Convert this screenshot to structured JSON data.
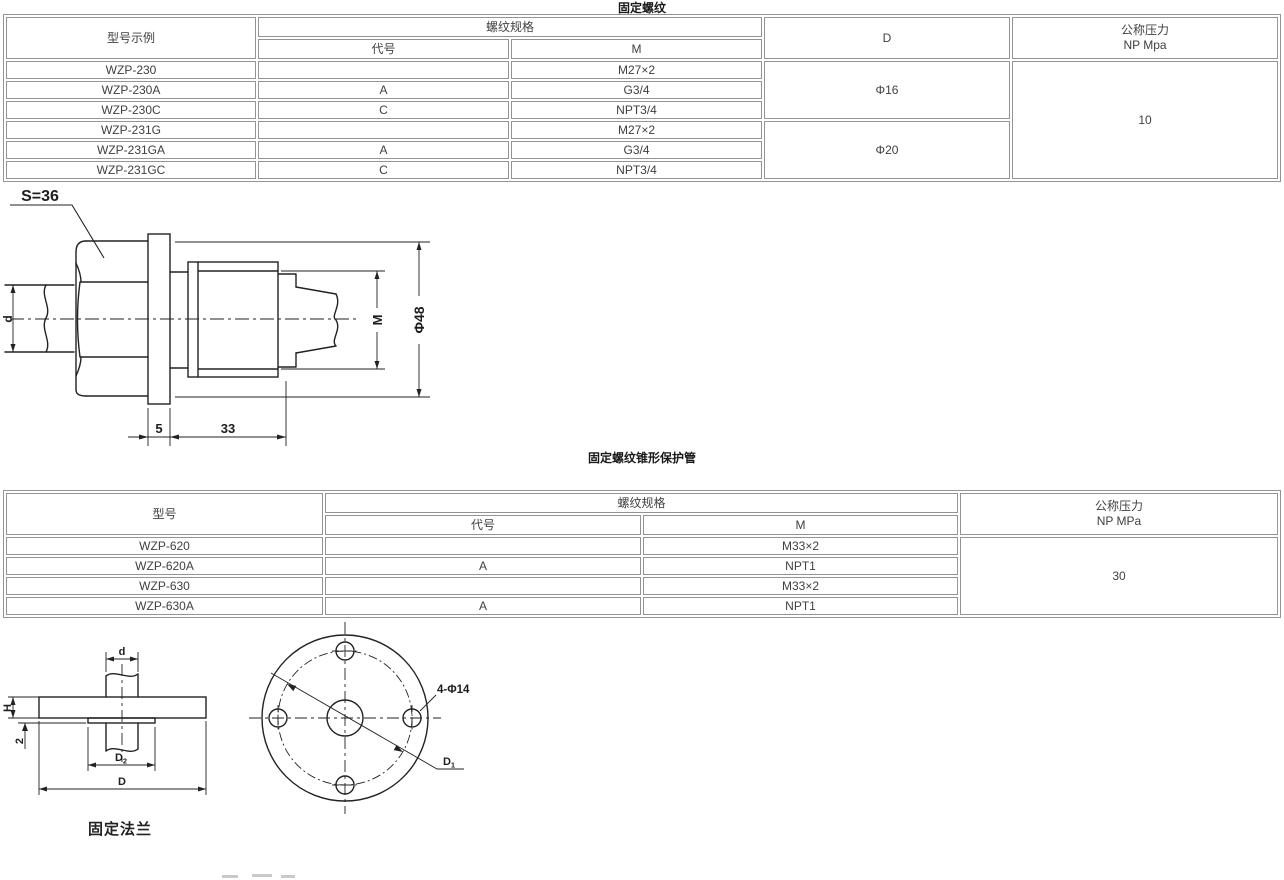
{
  "section1": {
    "title": "固定螺纹",
    "table": {
      "col_model": "型号示例",
      "col_thread_spec": "螺纹规格",
      "col_code": "代号",
      "col_m": "M",
      "col_d": "D",
      "col_pressure_l1": "公称压力",
      "col_pressure_l2": "NP Mpa",
      "rows": [
        {
          "model": "WZP-230",
          "code": "",
          "m": "M27×2"
        },
        {
          "model": "WZP-230A",
          "code": "A",
          "m": "G3/4"
        },
        {
          "model": "WZP-230C",
          "code": "C",
          "m": "NPT3/4"
        },
        {
          "model": "WZP-231G",
          "code": "",
          "m": "M27×2"
        },
        {
          "model": "WZP-231GA",
          "code": "A",
          "m": "G3/4"
        },
        {
          "model": "WZP-231GC",
          "code": "C",
          "m": "NPT3/4"
        }
      ],
      "d_group1": "Φ16",
      "d_group2": "Φ20",
      "pressure": "10"
    },
    "drawing": {
      "s_label": "S=36",
      "d_label": "d",
      "m_label": "M",
      "dia_label": "Φ48",
      "dim_5": "5",
      "dim_33": "33"
    }
  },
  "section2": {
    "title": "固定螺纹锥形保护管",
    "table": {
      "col_model": "型号",
      "col_thread_spec": "螺纹规格",
      "col_code": "代号",
      "col_m": "M",
      "col_pressure_l1": "公称压力",
      "col_pressure_l2": "NP MPa",
      "rows": [
        {
          "model": "WZP-620",
          "code": "",
          "m": "M33×2"
        },
        {
          "model": "WZP-620A",
          "code": "A",
          "m": "NPT1"
        },
        {
          "model": "WZP-630",
          "code": "",
          "m": "M33×2"
        },
        {
          "model": "WZP-630A",
          "code": "A",
          "m": "NPT1"
        }
      ],
      "pressure": "30"
    }
  },
  "flange": {
    "caption": "固定法兰",
    "side": {
      "d_label": "d",
      "h_label": "H",
      "two_label": "2",
      "d2_main": "D",
      "d2_sub": "2",
      "d_main": "D"
    },
    "top": {
      "holes_label": "4-Φ14",
      "d1_main": "D",
      "d1_sub": "1"
    }
  }
}
